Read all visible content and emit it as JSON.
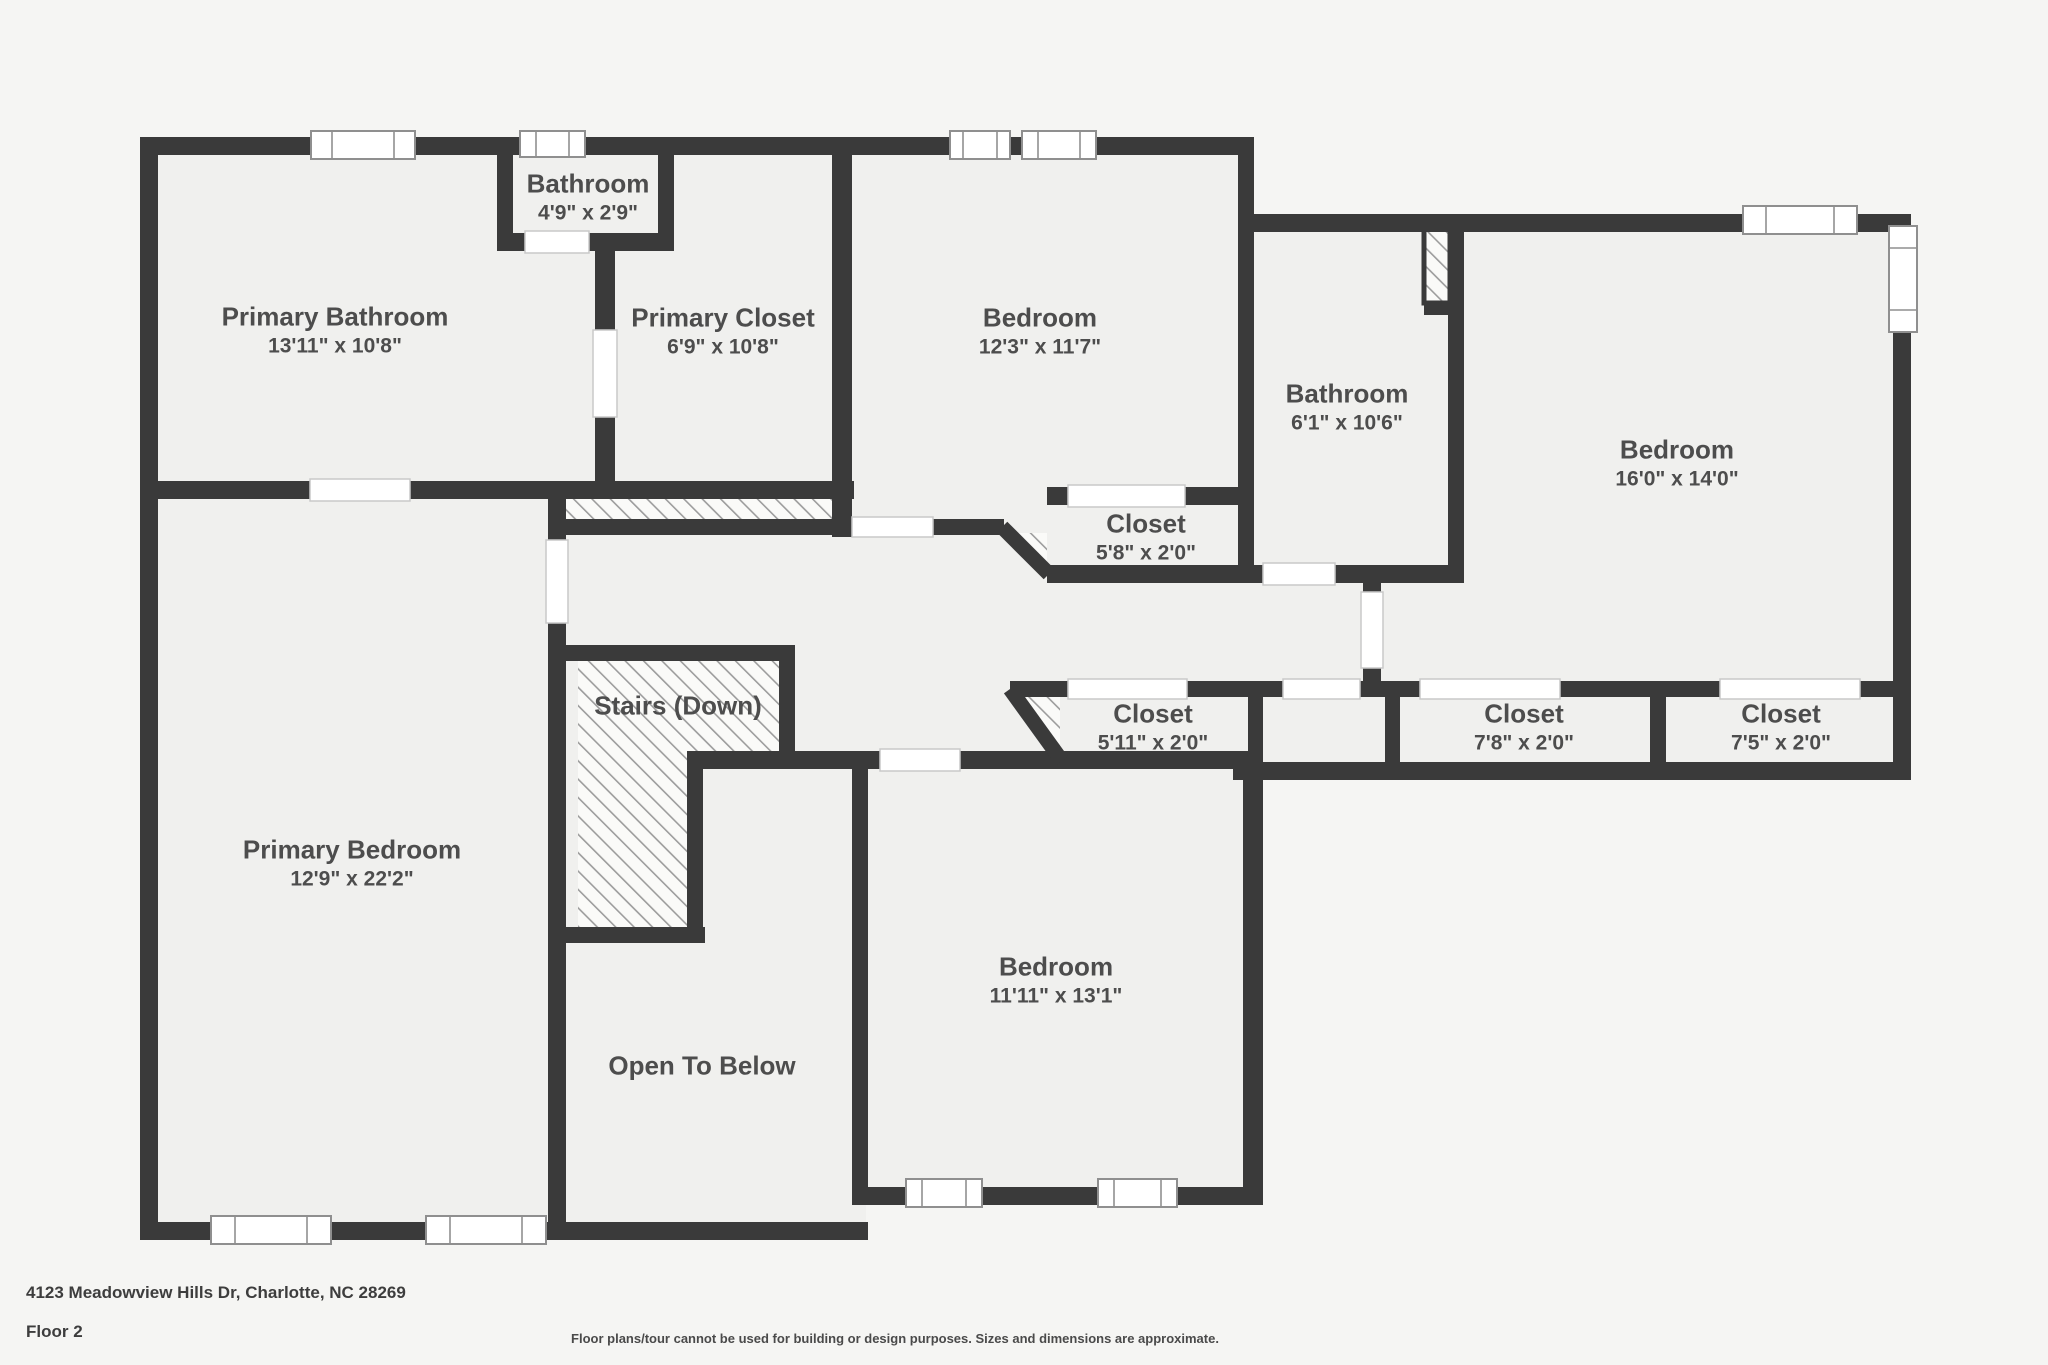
{
  "floorplan": {
    "rooms": [
      {
        "id": "primary-bathroom",
        "name": "Primary Bathroom",
        "dims": "13'11\" x 10'8\""
      },
      {
        "id": "bathroom-top",
        "name": "Bathroom",
        "dims": "4'9\" x 2'9\""
      },
      {
        "id": "primary-closet",
        "name": "Primary Closet",
        "dims": "6'9\" x 10'8\""
      },
      {
        "id": "bedroom-top",
        "name": "Bedroom",
        "dims": "12'3\" x 11'7\""
      },
      {
        "id": "bathroom-middle",
        "name": "Bathroom",
        "dims": "6'1\" x 10'6\""
      },
      {
        "id": "bedroom-right",
        "name": "Bedroom",
        "dims": "16'0\" x 14'0\""
      },
      {
        "id": "closet-bedroom",
        "name": "Closet",
        "dims": "5'8\" x 2'0\""
      },
      {
        "id": "closet-hall",
        "name": "Closet",
        "dims": "5'11\" x 2'0\""
      },
      {
        "id": "closet-mid-right",
        "name": "Closet",
        "dims": "7'8\" x 2'0\""
      },
      {
        "id": "closet-far-right",
        "name": "Closet",
        "dims": "7'5\" x 2'0\""
      },
      {
        "id": "primary-bedroom",
        "name": "Primary Bedroom",
        "dims": "12'9\" x 22'2\""
      },
      {
        "id": "bedroom-bottom",
        "name": "Bedroom",
        "dims": "11'11\" x 13'1\""
      }
    ],
    "stairs_label": "Stairs (Down)",
    "open_below_label": "Open To Below"
  },
  "footer": {
    "address": "4123 Meadowview Hills Dr, Charlotte, NC 28269",
    "floor": "Floor 2",
    "disclaimer": "Floor plans/tour cannot be used for building or design purposes. Sizes and dimensions are approximate."
  },
  "colors": {
    "wall": "#3a3a3a",
    "floor": "#f0f0ee",
    "background": "#f5f5f3",
    "label_text": "#4d4d4d",
    "hatch_line": "#9c9c9c"
  }
}
